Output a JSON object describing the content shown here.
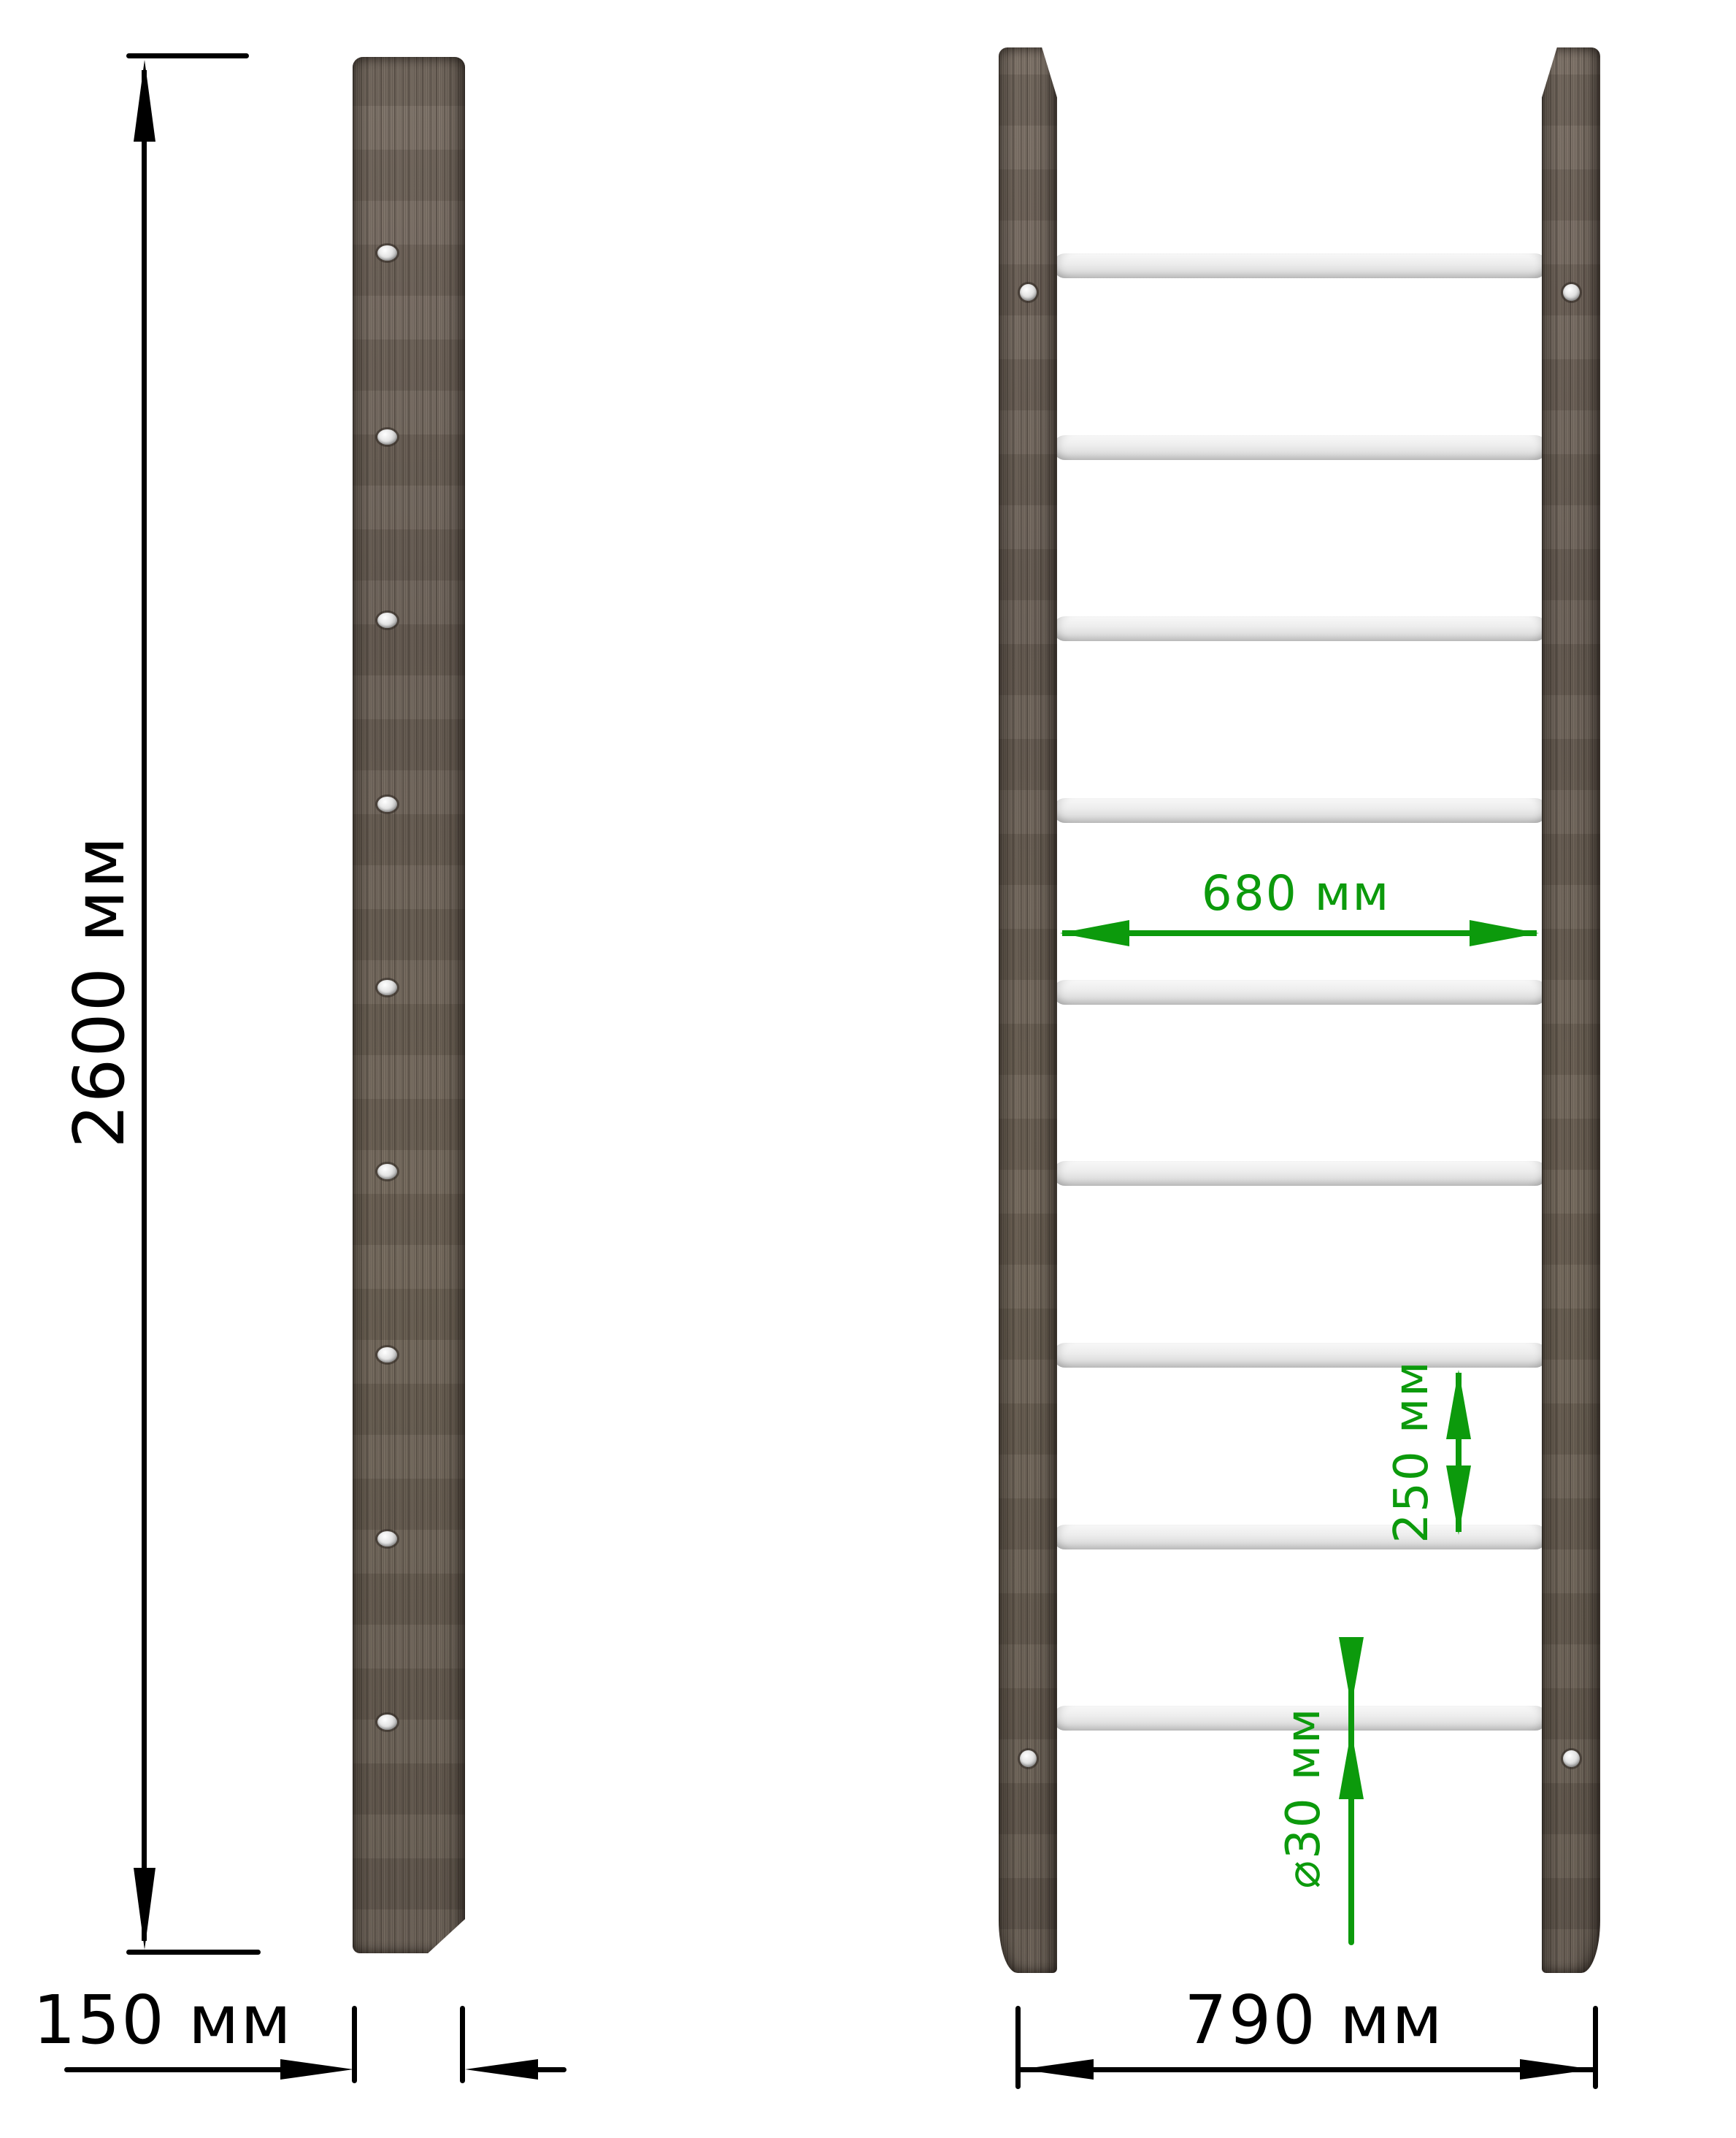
{
  "units": "мм",
  "colors": {
    "background": "#ffffff",
    "dimension_black": "#000000",
    "dimension_green": "#0c9a0c",
    "wood_base": "#6e6359",
    "rung_fill": "#ececec",
    "screw_fill": "#d9d9d9"
  },
  "side_view": {
    "overall_height_label": "2600 мм",
    "depth_label": "150 мм",
    "screw_count": 9
  },
  "front_view": {
    "overall_width_label": "790 мм",
    "inner_width_label": "680 мм",
    "rung_spacing_label": "250 мм",
    "rung_diameter_label": "⌀30 мм",
    "rung_count": 9,
    "screw_count": 4
  }
}
